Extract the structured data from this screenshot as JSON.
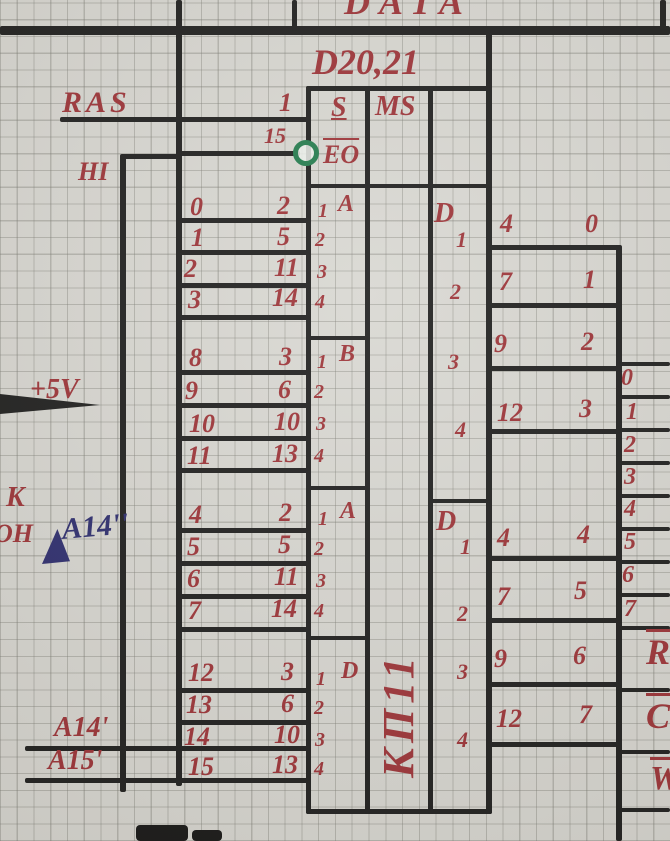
{
  "top": {
    "bus_label": "DATA"
  },
  "labels": {
    "ras": "RAS",
    "hi": "HI",
    "v5": "+5V",
    "k": "K",
    "on": "ОН",
    "a14_note": "A14''",
    "a14": "A14'",
    "a15": "A15'"
  },
  "chip": {
    "ref": "D20,21",
    "func_label": "MS",
    "part": "КП11",
    "select_pin": "1",
    "select_name": "S",
    "enable_pin": "15",
    "enable_name": "EO",
    "groups": [
      {
        "letter": "A",
        "rows": [
          {
            "line": "0",
            "pin": "2",
            "idx": "1"
          },
          {
            "line": "1",
            "pin": "5",
            "idx": "2"
          },
          {
            "line": "2",
            "pin": "11",
            "idx": "3"
          },
          {
            "line": "3",
            "pin": "14",
            "idx": "4"
          }
        ]
      },
      {
        "letter": "B",
        "rows": [
          {
            "line": "8",
            "pin": "3",
            "idx": "1"
          },
          {
            "line": "9",
            "pin": "6",
            "idx": "2"
          },
          {
            "line": "10",
            "pin": "10",
            "idx": "3"
          },
          {
            "line": "11",
            "pin": "13",
            "idx": "4"
          }
        ]
      },
      {
        "letter": "A",
        "rows": [
          {
            "line": "4",
            "pin": "2",
            "idx": "1"
          },
          {
            "line": "5",
            "pin": "5",
            "idx": "2"
          },
          {
            "line": "6",
            "pin": "11",
            "idx": "3"
          },
          {
            "line": "7",
            "pin": "14",
            "idx": "4"
          }
        ]
      },
      {
        "letter": "D",
        "rows": [
          {
            "line": "12",
            "pin": "3",
            "idx": "1"
          },
          {
            "line": "13",
            "pin": "6",
            "idx": "2"
          },
          {
            "line": "14",
            "pin": "10",
            "idx": "3"
          },
          {
            "line": "15",
            "pin": "13",
            "idx": "4"
          }
        ]
      }
    ],
    "outputs": [
      {
        "name": "D",
        "rows": [
          {
            "idx": "1",
            "pin": "4",
            "line": "0"
          },
          {
            "idx": "2",
            "pin": "7",
            "line": "1"
          },
          {
            "idx": "3",
            "pin": "9",
            "line": "2"
          },
          {
            "idx": "4",
            "pin": "12",
            "line": "3"
          }
        ]
      },
      {
        "name": "D",
        "rows": [
          {
            "idx": "1",
            "pin": "4",
            "line": "4"
          },
          {
            "idx": "2",
            "pin": "7",
            "line": "5"
          },
          {
            "idx": "3",
            "pin": "9",
            "line": "6"
          },
          {
            "idx": "4",
            "pin": "12",
            "line": "7"
          }
        ]
      }
    ]
  },
  "right_bus": {
    "lines": [
      "0",
      "1",
      "2",
      "3",
      "4",
      "5",
      "6",
      "7"
    ],
    "r": "R",
    "c": "C",
    "w": "W"
  }
}
